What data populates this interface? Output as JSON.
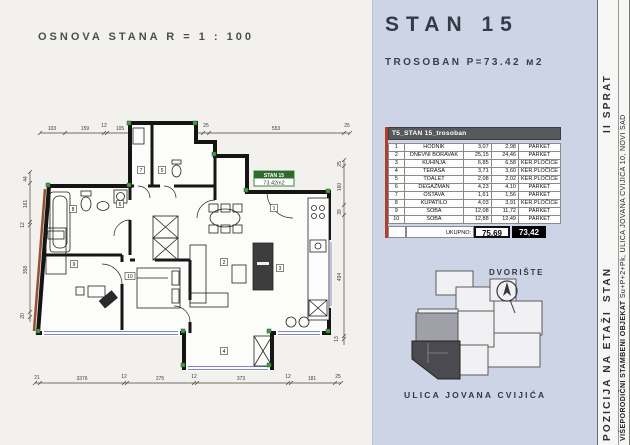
{
  "drawing_title": "OSNOVA STANA R = 1 : 100",
  "header": {
    "title": "STAN 15",
    "subtitle": "TROSOBAN P=73.42 м2"
  },
  "plan": {
    "unit_tag": {
      "line1": "STAN 15",
      "line2": "73.42m2"
    },
    "rooms": [
      "1",
      "2",
      "3",
      "4",
      "5",
      "6",
      "7",
      "8",
      "9",
      "10"
    ],
    "dims": {
      "top": [
        "103",
        "159",
        "12",
        "105",
        "25",
        "105",
        "12",
        "145",
        "25",
        "553",
        "25"
      ],
      "bottom": [
        "21",
        "3376",
        "12",
        "275",
        "12",
        "373",
        "12",
        "181",
        "25"
      ],
      "left": [
        "44",
        "161",
        "12",
        "358",
        "20"
      ],
      "right": [
        "25",
        "160",
        "39",
        "494",
        "13"
      ]
    }
  },
  "table": {
    "title": "T5_STAN 15_trosoban",
    "rows": [
      {
        "no": "1",
        "name": "HODNIK",
        "gross": "3,07",
        "net": "2,98",
        "floor": "PARKET"
      },
      {
        "no": "2",
        "name": "DNEVNI BORAVAK",
        "gross": "25,15",
        "net": "24,46",
        "floor": "PARKET"
      },
      {
        "no": "3",
        "name": "KUHINJA",
        "gross": "6,85",
        "net": "6,58",
        "floor": "KER.PLOČICE"
      },
      {
        "no": "4",
        "name": "TERASA",
        "gross": "3,71",
        "net": "3,60",
        "floor": "KER.PLOČICE"
      },
      {
        "no": "5",
        "name": "TOALET",
        "gross": "2,08",
        "net": "2,02",
        "floor": "KER.PLOČICE"
      },
      {
        "no": "6",
        "name": "DEGAŽMAN",
        "gross": "4,23",
        "net": "4,10",
        "floor": "PARKET"
      },
      {
        "no": "7",
        "name": "OSTAVA",
        "gross": "1,61",
        "net": "1,56",
        "floor": "PARKET"
      },
      {
        "no": "8",
        "name": "KUPATILO",
        "gross": "4,03",
        "net": "3,91",
        "floor": "KER.PLOČICE"
      },
      {
        "no": "9",
        "name": "SOBA",
        "gross": "12,08",
        "net": "11,72",
        "floor": "PARKET"
      },
      {
        "no": "10",
        "name": "SOBA",
        "gross": "12,88",
        "net": "12,49",
        "floor": "PARKET"
      }
    ],
    "total": {
      "label": "UKUPNO:",
      "gross": "75,69",
      "net": "73,42"
    }
  },
  "site": {
    "courtyard": "DVORIŠTE",
    "street": "ULICA JOVANA CVIJIĆA"
  },
  "side": {
    "position": "POZICIJA NA ETAŽI",
    "unit": "STAN",
    "floor": "II SPRAT",
    "building_bold": "VIŠEPORODIČNI STAMBENI OBJEKAT",
    "building_rest": " Su+P+2+Pk, ULICA JOVANA CVIJIĆA 10, NOVI SAD"
  },
  "colors": {
    "panel_blue": "#ccd4e6",
    "table_header_gray": "#58595b",
    "accent_red": "#b0402c",
    "marker_green": "#4a9a4a",
    "window_blue": "#7b86c2"
  }
}
